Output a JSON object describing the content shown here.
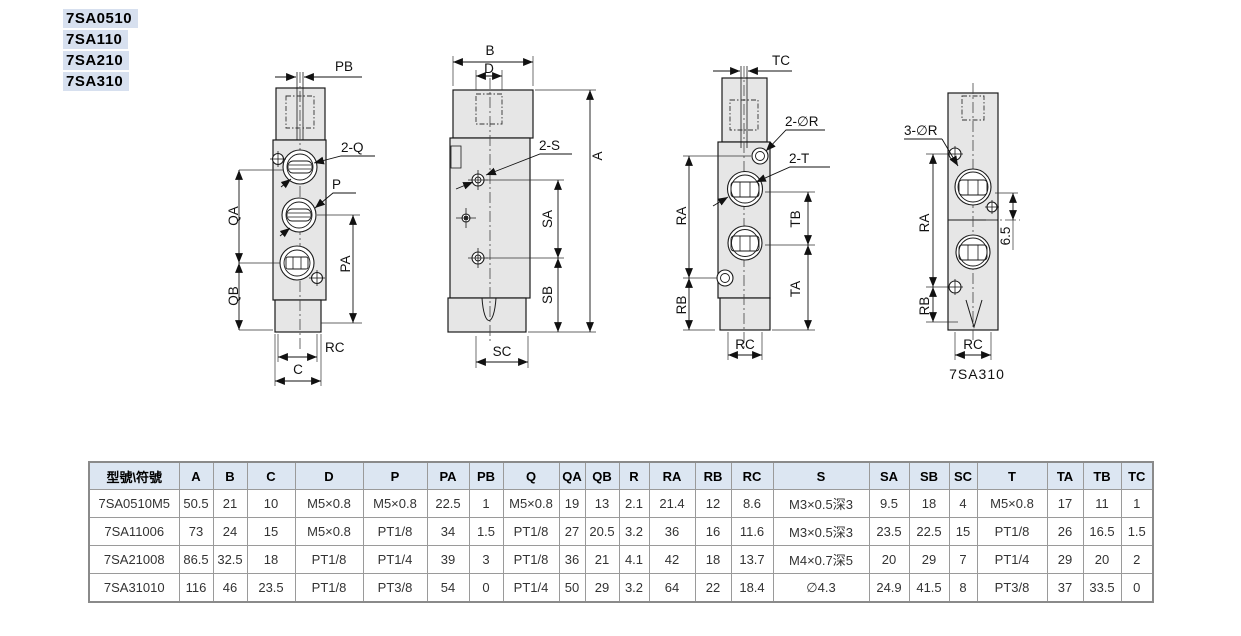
{
  "models": [
    "7SA0510",
    "7SA110",
    "7SA210",
    "7SA310"
  ],
  "drawings": {
    "d1": {
      "pb": "PB",
      "q2": "2-Q",
      "p": "P",
      "qa": "QA",
      "qb": "QB",
      "pa": "PA",
      "rc": "RC",
      "c": "C"
    },
    "d2": {
      "b": "B",
      "d": "D",
      "a": "A",
      "s2": "2-S",
      "sa": "SA",
      "sb": "SB",
      "sc": "SC"
    },
    "d3": {
      "tc": "TC",
      "r2": "2-∅R",
      "t2": "2-T",
      "ra": "RA",
      "rb": "RB",
      "tb": "TB",
      "ta": "TA",
      "rc": "RC"
    },
    "d4": {
      "r3": "3-∅R",
      "ra": "RA",
      "rb": "RB",
      "d65": "6.5",
      "rc": "RC",
      "caption": "7SA310"
    }
  },
  "table": {
    "headers": [
      "型號\\符號",
      "A",
      "B",
      "C",
      "D",
      "P",
      "PA",
      "PB",
      "Q",
      "QA",
      "QB",
      "R",
      "RA",
      "RB",
      "RC",
      "S",
      "SA",
      "SB",
      "SC",
      "T",
      "TA",
      "TB",
      "TC"
    ],
    "rows": [
      [
        "7SA0510M5",
        "50.5",
        "21",
        "10",
        "M5×0.8",
        "M5×0.8",
        "22.5",
        "1",
        "M5×0.8",
        "19",
        "13",
        "2.1",
        "21.4",
        "12",
        "8.6",
        "M3×0.5深3",
        "9.5",
        "18",
        "4",
        "M5×0.8",
        "17",
        "11",
        "1"
      ],
      [
        "7SA11006",
        "73",
        "24",
        "15",
        "M5×0.8",
        "PT1/8",
        "34",
        "1.5",
        "PT1/8",
        "27",
        "20.5",
        "3.2",
        "36",
        "16",
        "11.6",
        "M3×0.5深3",
        "23.5",
        "22.5",
        "15",
        "PT1/8",
        "26",
        "16.5",
        "1.5"
      ],
      [
        "7SA21008",
        "86.5",
        "32.5",
        "18",
        "PT1/8",
        "PT1/4",
        "39",
        "3",
        "PT1/8",
        "36",
        "21",
        "4.1",
        "42",
        "18",
        "13.7",
        "M4×0.7深5",
        "20",
        "29",
        "7",
        "PT1/4",
        "29",
        "20",
        "2"
      ],
      [
        "7SA31010",
        "116",
        "46",
        "23.5",
        "PT1/8",
        "PT3/8",
        "54",
        "0",
        "PT1/4",
        "50",
        "29",
        "3.2",
        "64",
        "22",
        "18.4",
        "∅4.3",
        "24.9",
        "41.5",
        "8",
        "PT3/8",
        "37",
        "33.5",
        "0"
      ]
    ]
  },
  "colors": {
    "table_header_bg": "#dce6f2",
    "model_label_bg": "#d7e0ef",
    "drawing_fill": "#e6e6e6",
    "line": "#1a1a1a",
    "table_border": "#9a9a9a"
  }
}
